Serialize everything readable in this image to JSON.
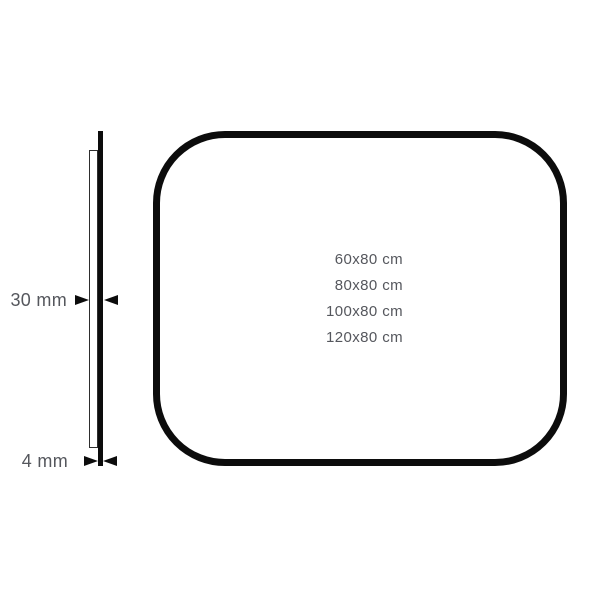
{
  "page": {
    "background": "#ffffff"
  },
  "diagram": {
    "board": {
      "sizes": [
        "60x80 cm",
        "80x80 cm",
        "100x80 cm",
        "120x80 cm"
      ]
    },
    "side_profile": {
      "depth_label": "30 mm",
      "thickness_label": "4 mm"
    },
    "colors": {
      "line": "#0c0c0c",
      "thin_line": "#2e2e2e",
      "label_text": "#55575d"
    }
  }
}
